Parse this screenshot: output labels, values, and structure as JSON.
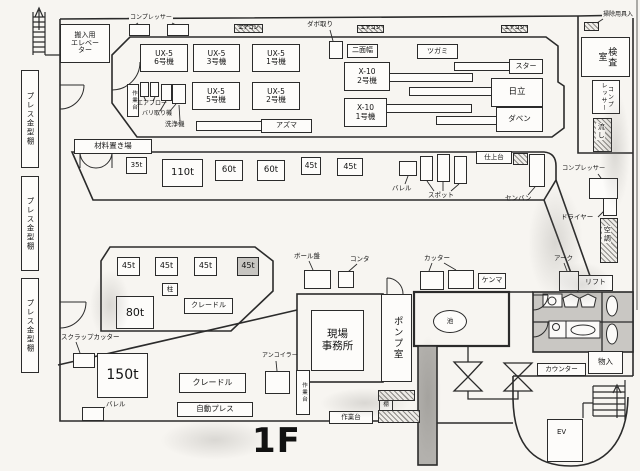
{
  "title": "1F 工場レイアウト図",
  "floor": "1F",
  "colors": {
    "wall": "#2b2b2b",
    "paper": "#f7f5f1",
    "hatch": "#8d8b87",
    "shade": "#c7c5c1",
    "toilet_fill": "#c9c7c3",
    "channel_fill": "#b3b1ad"
  },
  "boxes": [
    {
      "n": "elevator-room",
      "t": "搬入用\nエレベー\nター",
      "x": 60,
      "y": 24,
      "w": 50,
      "h": 39,
      "fs": 7
    },
    {
      "n": "press-mold-shelf-1",
      "t": "プレス金型棚",
      "x": 21,
      "y": 70,
      "w": 18,
      "h": 98,
      "fs": 7.5,
      "c": "vert"
    },
    {
      "n": "press-mold-shelf-2",
      "t": "プレス金型棚",
      "x": 21,
      "y": 176,
      "w": 18,
      "h": 95,
      "fs": 7.5,
      "c": "vert"
    },
    {
      "n": "press-mold-shelf-3",
      "t": "プレス金型棚",
      "x": 21,
      "y": 278,
      "w": 18,
      "h": 95,
      "fs": 7.5,
      "c": "vert"
    },
    {
      "n": "machine-ux5-6",
      "t": "UX-5\n6号機",
      "x": 140,
      "y": 44,
      "w": 48,
      "h": 28,
      "fs": 7.5
    },
    {
      "n": "machine-ux5-3",
      "t": "UX-5\n3号機",
      "x": 193,
      "y": 44,
      "w": 47,
      "h": 28,
      "fs": 7.5
    },
    {
      "n": "machine-ux5-1",
      "t": "UX-5\n1号機",
      "x": 252,
      "y": 44,
      "w": 48,
      "h": 28,
      "fs": 7.5
    },
    {
      "n": "machine-ux5-5",
      "t": "UX-5\n5号機",
      "x": 192,
      "y": 82,
      "w": 48,
      "h": 28,
      "fs": 7.5
    },
    {
      "n": "machine-ux5-2",
      "t": "UX-5\n2号機",
      "x": 252,
      "y": 82,
      "w": 48,
      "h": 28,
      "fs": 7.5
    },
    {
      "n": "workbench-top",
      "t": "作業台",
      "x": 127,
      "y": 84,
      "w": 12,
      "h": 33,
      "fs": 5.5,
      "c": "vert"
    },
    {
      "n": "machine-x10-2",
      "t": "X-10\n2号機",
      "x": 344,
      "y": 62,
      "w": 46,
      "h": 29,
      "fs": 7.5
    },
    {
      "n": "machine-x10-1",
      "t": "X-10\n1号機",
      "x": 344,
      "y": 98,
      "w": 43,
      "h": 29,
      "fs": 7.5
    },
    {
      "n": "machine-nimenhaba",
      "t": "二面幅",
      "x": 347,
      "y": 44,
      "w": 31,
      "h": 14,
      "fs": 7
    },
    {
      "n": "machine-tsugami",
      "t": "ツガミ",
      "x": 417,
      "y": 44,
      "w": 41,
      "h": 15,
      "fs": 7
    },
    {
      "n": "machine-star",
      "t": "スター",
      "x": 509,
      "y": 59,
      "w": 34,
      "h": 15,
      "fs": 7
    },
    {
      "n": "machine-hitachi",
      "t": "日立",
      "x": 491,
      "y": 78,
      "w": 52,
      "h": 29,
      "fs": 8.5
    },
    {
      "n": "machine-daben",
      "t": "ダベン",
      "x": 496,
      "y": 107,
      "w": 47,
      "h": 25,
      "fs": 7.5
    },
    {
      "n": "machine-azuma",
      "t": "アズマ",
      "x": 261,
      "y": 119,
      "w": 51,
      "h": 14,
      "fs": 7
    },
    {
      "n": "material-storage",
      "t": "材料置き場",
      "x": 74,
      "y": 139,
      "w": 78,
      "h": 15,
      "fs": 7.5
    },
    {
      "n": "press-35t",
      "t": "35t",
      "x": 126,
      "y": 157,
      "w": 21,
      "h": 17,
      "fs": 7
    },
    {
      "n": "press-110t",
      "t": "110t",
      "x": 162,
      "y": 159,
      "w": 41,
      "h": 28,
      "fs": 10
    },
    {
      "n": "press-60t-1",
      "t": "60t",
      "x": 215,
      "y": 160,
      "w": 28,
      "h": 21,
      "fs": 8.5
    },
    {
      "n": "press-60t-2",
      "t": "60t",
      "x": 257,
      "y": 160,
      "w": 28,
      "h": 21,
      "fs": 8.5
    },
    {
      "n": "press-45t-1",
      "t": "45t",
      "x": 301,
      "y": 157,
      "w": 20,
      "h": 18,
      "fs": 7.5
    },
    {
      "n": "press-45t-2",
      "t": "45t",
      "x": 337,
      "y": 158,
      "w": 26,
      "h": 18,
      "fs": 8
    },
    {
      "n": "finishing-table",
      "t": "仕上台",
      "x": 476,
      "y": 151,
      "w": 36,
      "h": 13,
      "fs": 6.5
    },
    {
      "n": "shelf-hatch-right",
      "x": 513,
      "y": 153,
      "w": 15,
      "h": 12,
      "c": "hatch"
    },
    {
      "n": "inspection-room",
      "t": "検査\n室",
      "x": 581,
      "y": 37,
      "w": 49,
      "h": 40,
      "fs": 9,
      "c": "vert"
    },
    {
      "n": "compressor-vert-box",
      "t": "コンプ\nレッサー",
      "x": 592,
      "y": 80,
      "w": 28,
      "h": 34,
      "fs": 6,
      "c": "vert"
    },
    {
      "n": "sink-box",
      "x": 593,
      "y": 118,
      "w": 19,
      "h": 34,
      "c": "hatch"
    },
    {
      "n": "cleaning-storage-box",
      "x": 584,
      "y": 22,
      "w": 15,
      "h": 9,
      "c": "hatch"
    },
    {
      "n": "aircon-box-1",
      "t": "エアコン",
      "x": 234,
      "y": 24,
      "w": 29,
      "h": 9,
      "fs": 5,
      "c": "hatch"
    },
    {
      "n": "aircon-box-2",
      "t": "エアコン",
      "x": 357,
      "y": 25,
      "w": 27,
      "h": 8,
      "fs": 5,
      "c": "hatch"
    },
    {
      "n": "aircon-box-3",
      "t": "エアコン",
      "x": 501,
      "y": 25,
      "w": 27,
      "h": 8,
      "fs": 5,
      "c": "hatch"
    },
    {
      "n": "press-45t-3",
      "t": "45t",
      "x": 117,
      "y": 257,
      "w": 23,
      "h": 19,
      "fs": 8
    },
    {
      "n": "press-45t-4",
      "t": "45t",
      "x": 155,
      "y": 257,
      "w": 23,
      "h": 19,
      "fs": 8
    },
    {
      "n": "press-45t-5",
      "t": "45t",
      "x": 194,
      "y": 257,
      "w": 23,
      "h": 19,
      "fs": 8
    },
    {
      "n": "press-45t-6",
      "t": "45t",
      "x": 237,
      "y": 257,
      "w": 22,
      "h": 19,
      "fs": 8,
      "c": "shade"
    },
    {
      "n": "pillar",
      "t": "柱",
      "x": 162,
      "y": 283,
      "w": 16,
      "h": 13,
      "fs": 6.5
    },
    {
      "n": "press-80t",
      "t": "80t",
      "x": 116,
      "y": 296,
      "w": 38,
      "h": 33,
      "fs": 11
    },
    {
      "n": "cradle-mid",
      "t": "クレードル",
      "x": 184,
      "y": 298,
      "w": 49,
      "h": 16,
      "fs": 7
    },
    {
      "n": "press-150t",
      "t": "150t",
      "x": 97,
      "y": 353,
      "w": 51,
      "h": 45,
      "fs": 14
    },
    {
      "n": "cradle-bottom",
      "t": "クレードル",
      "x": 179,
      "y": 373,
      "w": 67,
      "h": 20,
      "fs": 8
    },
    {
      "n": "auto-press",
      "t": "自動プレス",
      "x": 177,
      "y": 402,
      "w": 76,
      "h": 15,
      "fs": 7.5
    },
    {
      "n": "site-office",
      "t": "現場\n事務所",
      "x": 311,
      "y": 310,
      "w": 53,
      "h": 61,
      "fs": 10.5
    },
    {
      "n": "pump-room",
      "t": "ポンプ室",
      "x": 381,
      "y": 294,
      "w": 31,
      "h": 88,
      "fs": 9.5,
      "c": "vert"
    },
    {
      "n": "workbench-left-vert",
      "t": "作業台",
      "x": 296,
      "y": 370,
      "w": 14,
      "h": 45,
      "fs": 5.5,
      "c": "vert"
    },
    {
      "n": "workbench-bottom",
      "t": "作業台",
      "x": 329,
      "y": 411,
      "w": 44,
      "h": 13,
      "fs": 6.5
    },
    {
      "n": "shelf-small",
      "t": "棚",
      "x": 379,
      "y": 400,
      "w": 14,
      "h": 11,
      "fs": 5.5
    },
    {
      "n": "shelf-hatch-1",
      "x": 378,
      "y": 390,
      "w": 37,
      "h": 11,
      "c": "hatch"
    },
    {
      "n": "shelf-hatch-2",
      "x": 378,
      "y": 410,
      "w": 42,
      "h": 13,
      "c": "hatch"
    },
    {
      "n": "kenma",
      "t": "ケンマ",
      "x": 478,
      "y": 273,
      "w": 28,
      "h": 16,
      "fs": 7
    },
    {
      "n": "lift",
      "t": "リフト",
      "x": 578,
      "y": 275,
      "w": 35,
      "h": 16,
      "fs": 7
    },
    {
      "n": "counter",
      "t": "カウンター",
      "x": 537,
      "y": 363,
      "w": 49,
      "h": 13,
      "fs": 6.5
    },
    {
      "n": "storage-small-room",
      "t": "物入",
      "x": 588,
      "y": 351,
      "w": 35,
      "h": 23,
      "fs": 7.5
    },
    {
      "n": "ev-box",
      "x": 547,
      "y": 419,
      "w": 36,
      "h": 43
    },
    {
      "n": "aircon-duct",
      "x": 600,
      "y": 218,
      "w": 18,
      "h": 45,
      "c": "hatch"
    },
    {
      "n": "pond",
      "t": "池",
      "x": 433,
      "y": 310,
      "w": 34,
      "h": 23,
      "fs": 6.5,
      "c": "ell"
    },
    {
      "n": "compressor-top-box-1",
      "x": 129,
      "y": 24,
      "w": 21,
      "h": 12
    },
    {
      "n": "compressor-top-box-2",
      "x": 167,
      "y": 24,
      "w": 22,
      "h": 12
    },
    {
      "n": "dabotori-box",
      "x": 329,
      "y": 41,
      "w": 14,
      "h": 18
    },
    {
      "n": "airblow-box-1",
      "x": 140,
      "y": 82,
      "w": 9,
      "h": 15
    },
    {
      "n": "airblow-box-2",
      "x": 150,
      "y": 82,
      "w": 9,
      "h": 15
    },
    {
      "n": "baritori-box",
      "x": 161,
      "y": 84,
      "w": 11,
      "h": 17
    },
    {
      "n": "washer-box",
      "x": 172,
      "y": 84,
      "w": 14,
      "h": 20
    },
    {
      "n": "barrel-mid-box",
      "x": 399,
      "y": 161,
      "w": 18,
      "h": 15
    },
    {
      "n": "spot-box-1",
      "x": 420,
      "y": 156,
      "w": 13,
      "h": 25
    },
    {
      "n": "spot-box-2",
      "x": 437,
      "y": 154,
      "w": 13,
      "h": 28
    },
    {
      "n": "spot-box-3",
      "x": 454,
      "y": 156,
      "w": 13,
      "h": 28
    },
    {
      "n": "senban-box",
      "x": 529,
      "y": 154,
      "w": 16,
      "h": 33
    },
    {
      "n": "compressor-right-box",
      "x": 589,
      "y": 178,
      "w": 29,
      "h": 21
    },
    {
      "n": "dryer-box",
      "x": 603,
      "y": 198,
      "w": 14,
      "h": 18
    },
    {
      "n": "arc-box",
      "x": 559,
      "y": 271,
      "w": 20,
      "h": 20
    },
    {
      "n": "cutter-box-1",
      "x": 420,
      "y": 271,
      "w": 24,
      "h": 19
    },
    {
      "n": "cutter-box-2",
      "x": 448,
      "y": 270,
      "w": 26,
      "h": 19
    },
    {
      "n": "drill-press-box",
      "x": 304,
      "y": 270,
      "w": 27,
      "h": 19
    },
    {
      "n": "conta-box",
      "x": 338,
      "y": 271,
      "w": 16,
      "h": 17
    },
    {
      "n": "scrap-cutter-box",
      "x": 73,
      "y": 353,
      "w": 22,
      "h": 15
    },
    {
      "n": "barrel-bottom-box",
      "x": 82,
      "y": 407,
      "w": 22,
      "h": 14
    },
    {
      "n": "uncoiler-box",
      "x": 265,
      "y": 371,
      "w": 25,
      "h": 23
    },
    {
      "n": "bar-star",
      "x": 454,
      "y": 62,
      "w": 56,
      "h": 9
    },
    {
      "n": "bar-x10-2",
      "x": 389,
      "y": 73,
      "w": 84,
      "h": 9
    },
    {
      "n": "bar-hitachi",
      "x": 409,
      "y": 87,
      "w": 83,
      "h": 9
    },
    {
      "n": "bar-x10-1",
      "x": 386,
      "y": 104,
      "w": 86,
      "h": 9
    },
    {
      "n": "bar-daben",
      "x": 436,
      "y": 116,
      "w": 61,
      "h": 9
    },
    {
      "n": "bar-azuma",
      "x": 196,
      "y": 121,
      "w": 66,
      "h": 10
    }
  ],
  "texts": [
    {
      "n": "label-compressor-top",
      "t": "コンプレッサー",
      "x": 129,
      "y": 15,
      "fs": 6,
      "c": "bgw"
    },
    {
      "n": "label-dabotori",
      "t": "ダボ取り",
      "x": 306,
      "y": 21,
      "fs": 6.5,
      "c": "bgw"
    },
    {
      "n": "label-cleaning-storage",
      "t": "掃除用具入",
      "x": 602,
      "y": 12,
      "fs": 6,
      "c": "bgw"
    },
    {
      "n": "label-airblow",
      "t": "エアブロー",
      "x": 137,
      "y": 101,
      "fs": 6
    },
    {
      "n": "label-baritori",
      "t": "バリ取り機",
      "x": 142,
      "y": 111,
      "fs": 6
    },
    {
      "n": "label-washer",
      "t": "洗浄機",
      "x": 165,
      "y": 121,
      "fs": 6.5
    },
    {
      "n": "label-barrel-mid",
      "t": "バレル",
      "x": 392,
      "y": 185,
      "fs": 6.5
    },
    {
      "n": "label-spot",
      "t": "スポット",
      "x": 428,
      "y": 192,
      "fs": 6.5
    },
    {
      "n": "label-senban",
      "t": "センバン",
      "x": 505,
      "y": 195,
      "fs": 6.5
    },
    {
      "n": "label-compressor-right",
      "t": "コンプレッサー",
      "x": 562,
      "y": 166,
      "fs": 6.2
    },
    {
      "n": "label-dryer",
      "t": "ドライヤー",
      "x": 561,
      "y": 214,
      "fs": 6.5
    },
    {
      "n": "label-arc",
      "t": "アーク",
      "x": 554,
      "y": 255,
      "fs": 6.5
    },
    {
      "n": "label-drill-press",
      "t": "ボール盤",
      "x": 294,
      "y": 253,
      "fs": 6.5
    },
    {
      "n": "label-conta",
      "t": "コンタ",
      "x": 350,
      "y": 256,
      "fs": 6.5
    },
    {
      "n": "label-cutter",
      "t": "カッター",
      "x": 424,
      "y": 255,
      "fs": 6.5
    },
    {
      "n": "label-scrap-cutter",
      "t": "スクラップカッター",
      "x": 61,
      "y": 334,
      "fs": 6.5
    },
    {
      "n": "label-barrel-bottom",
      "t": "バレル",
      "x": 106,
      "y": 401,
      "fs": 6.5
    },
    {
      "n": "label-uncoiler",
      "t": "アンコイラー",
      "x": 262,
      "y": 353,
      "fs": 6
    },
    {
      "n": "label-aircon-duct",
      "t": "空調",
      "x": 602,
      "y": 226,
      "fs": 7,
      "c": "vert bgw"
    },
    {
      "n": "label-sink",
      "t": "流し",
      "x": 596,
      "y": 123,
      "fs": 7,
      "c": "vert bgw"
    },
    {
      "n": "label-ev",
      "t": "EV",
      "x": 557,
      "y": 429,
      "fs": 7
    },
    {
      "n": "floor-title",
      "t": "1F",
      "x": 252,
      "y": 424,
      "fs": 34,
      "c": "bold"
    }
  ]
}
